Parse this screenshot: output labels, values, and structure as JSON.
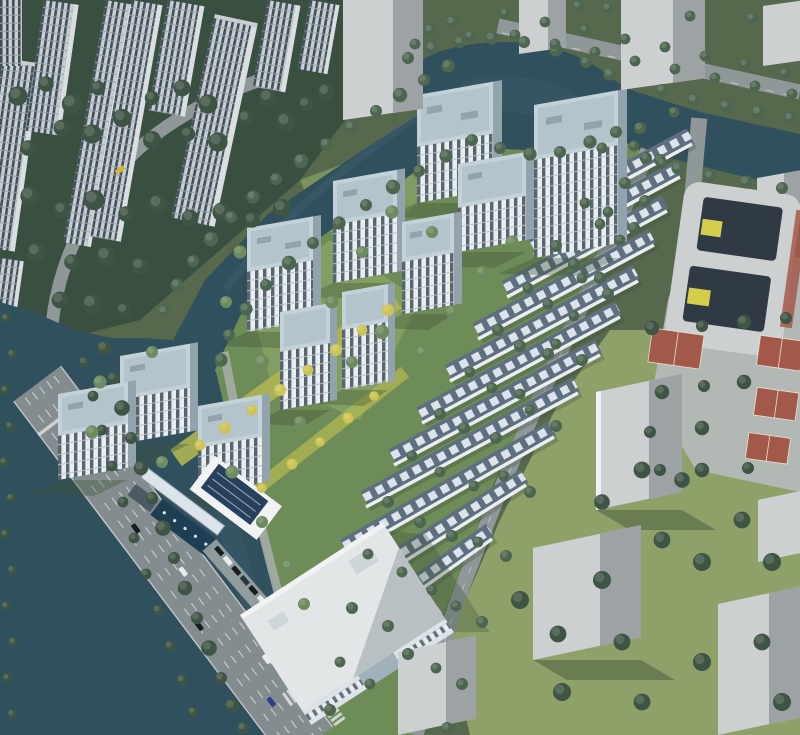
{
  "scene": {
    "type": "aerial-architectural-rendering",
    "subject": "residential-masterplan-birdseye",
    "highrise_towers": 11,
    "townhouse_rows": 12,
    "basketball_courts": 4,
    "water_features": [
      "canal",
      "pond",
      "river"
    ]
  },
  "palette": {
    "base_green": "#56694d",
    "forest_green": "#394f3f",
    "site_green": "#6e8c58",
    "lawn_green": "#87a364",
    "context_grass": "#8ea168",
    "shadow_green": "#3b5037",
    "tree_dark": "#3e5444",
    "tree_mid": "#4d6650",
    "tree_light": "#6d8b5e",
    "tree_yellow": "#cdc456",
    "water": "#31505e",
    "water_light": "#45687a",
    "road": "#8f9798",
    "road_major": "#838c8e",
    "road_line": "#d9dee0",
    "sidewalk": "#a8afac",
    "plaza": "#b2b8b3",
    "tower_wall": "#e9edf0",
    "tower_glass": "#55666f",
    "tower_side": "#92a3ad",
    "tower_roof": "#c3d1d9",
    "tower_roof_inner": "#b4c4cd",
    "bg_wall": "#c7cfd4",
    "bg_glass": "#42505a",
    "town_roof": "#5e707f",
    "town_panel": "#dbe4ea",
    "town_wall": "#eaeef0",
    "block_light": "#ccd0d1",
    "block_mid": "#b7bbbc",
    "block_dark": "#9da2a4",
    "court_red": "#a3594a",
    "school_court": "#2f3a44",
    "accent_yellow": "#d6ce4b",
    "pool_blue": "#1e3e54",
    "solar_blue": "#27415c",
    "car_dark": "#191d21",
    "car_white": "#e8ebec",
    "car_blue": "#2a3f8c",
    "car_yellow": "#d9b23a",
    "white": "#f0f2f3"
  }
}
